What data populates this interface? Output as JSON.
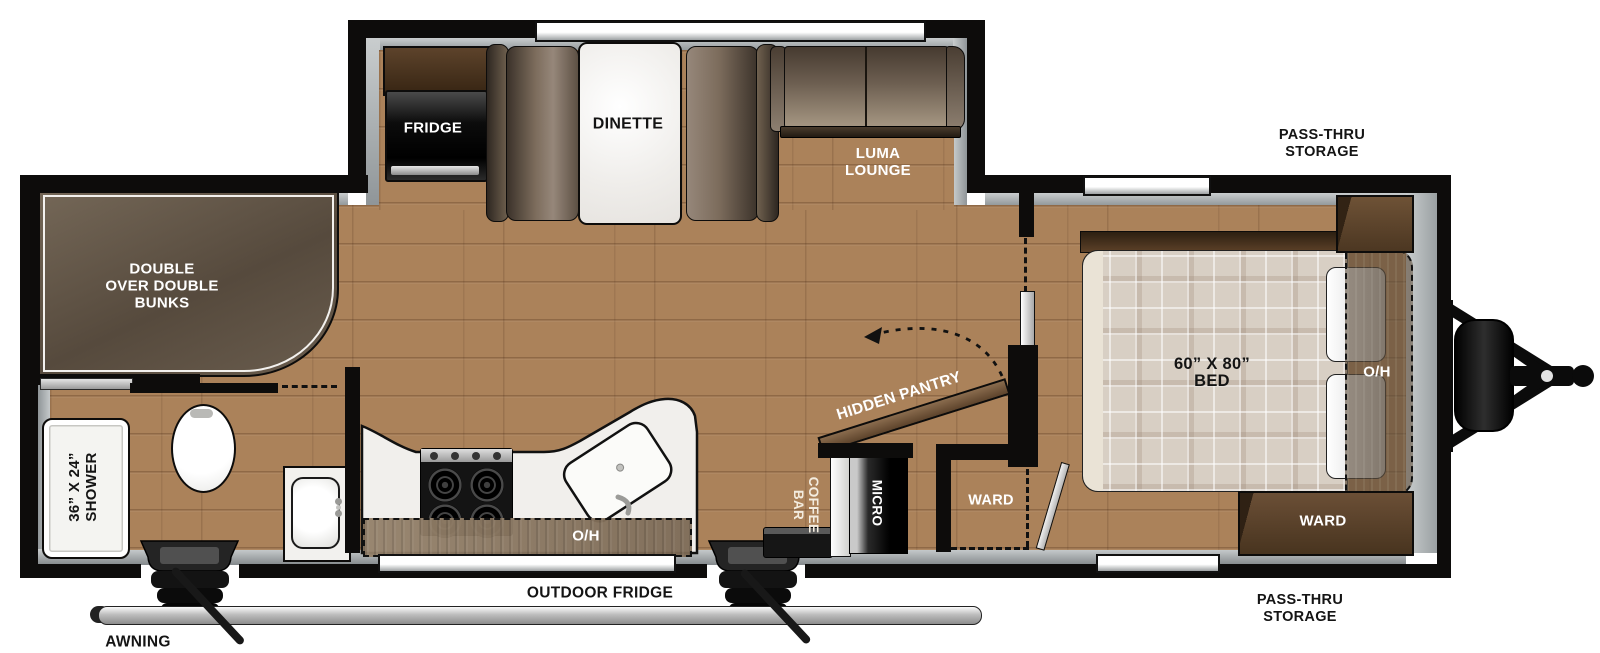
{
  "title": "Travel trailer floor plan",
  "colors": {
    "wall": "#0d0c0b",
    "floor_wood": "#ab825a",
    "lining_gray": "#aeb3b5",
    "furniture_brown": "#6b5d50",
    "cabinet_brown": "#5f4630",
    "fixture_white": "#f4f3f0",
    "appliance_black": "#141414",
    "mattress_beige": "#d8cfc4",
    "label_light": "#ffffff",
    "label_dark": "#141414"
  },
  "labels": {
    "fridge": "FRIDGE",
    "dinette": "DINETTE",
    "lounge_line1": "LUMA",
    "lounge_line2": "LOUNGE",
    "bunks_line1": "DOUBLE",
    "bunks_line2": "OVER DOUBLE",
    "bunks_line3": "BUNKS",
    "shower_line1": "36” X 24”",
    "shower_line2": "SHOWER",
    "hidden_pantry": "HIDDEN PANTRY",
    "coffee_line1": "COFFEE",
    "coffee_line2": "BAR",
    "micro": "MICRO",
    "ward_hall": "WARD",
    "ward_bed": "WARD",
    "bed_line1": "60” X 80”",
    "bed_line2": "BED",
    "oh_kitchen": "O/H",
    "oh_bed": "O/H",
    "outdoor_fridge": "OUTDOOR FRIDGE",
    "awning": "AWNING",
    "storage_top_line1": "PASS-THRU",
    "storage_top_line2": "STORAGE",
    "storage_bottom_line1": "PASS-THRU",
    "storage_bottom_line2": "STORAGE"
  }
}
